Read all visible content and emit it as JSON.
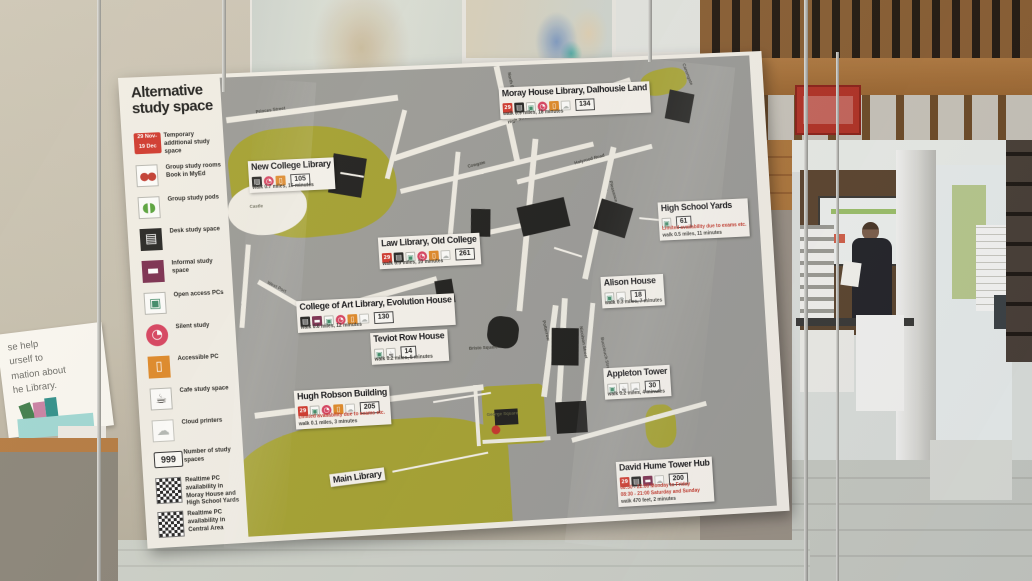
{
  "scene": {
    "left_sign": {
      "lines": [
        "se help",
        "urself to",
        "mation about",
        "he Library."
      ]
    }
  },
  "poster": {
    "title_line1": "Alternative",
    "title_line2": "study space",
    "legend": {
      "date_badge": {
        "line1": "29 Nov-",
        "line2": "19 Dec",
        "description": "Temporary additional study space"
      },
      "items": [
        {
          "icon": "group-study-rooms",
          "label": "Group study rooms Book in MyEd"
        },
        {
          "icon": "group-study-pods",
          "label": "Group study pods"
        },
        {
          "icon": "desk-study",
          "label": "Desk study space"
        },
        {
          "icon": "informal-study",
          "label": "Informal study space"
        },
        {
          "icon": "open-access-pc",
          "label": "Open access PCs"
        },
        {
          "icon": "silent-study",
          "label": "Silent study"
        },
        {
          "icon": "accessible-pc",
          "label": "Accessible PC"
        },
        {
          "icon": "cafe-study",
          "label": "Cafe study space"
        },
        {
          "icon": "cloud-printers",
          "label": "Cloud printers"
        }
      ],
      "number_badge": {
        "value": "999",
        "label": "Number of study spaces"
      },
      "qr_codes": [
        {
          "label": "Realtime PC availability in Moray House and High School Yards"
        },
        {
          "label": "Realtime PC availability in Central Area"
        }
      ]
    },
    "map": {
      "locations": [
        {
          "name": "New College Library",
          "icons": [
            "desk-study",
            "silent-study",
            "accessible-pc"
          ],
          "count": "105",
          "walk": "walk 0.7 miles, 15 minutes"
        },
        {
          "name": "Moray House Library, Dalhousie Land",
          "icons": [
            "date-badge",
            "desk-study",
            "open-access-pc",
            "silent-study",
            "accessible-pc",
            "cloud-printers"
          ],
          "count": "134",
          "walk": "walk 0.9 miles, 18 minutes"
        },
        {
          "name": "Law Library, Old College",
          "icons": [
            "date-badge",
            "desk-study",
            "open-access-pc",
            "silent-study",
            "accessible-pc",
            "cloud-printers"
          ],
          "count": "261",
          "walk": "walk 0.5 miles, 10 minutes"
        },
        {
          "name": "High School Yards",
          "icons": [
            "open-access-pc"
          ],
          "count": "61",
          "note": "Limited availability due to exams etc.",
          "walk": "walk 0.5 miles, 11 minutes"
        },
        {
          "name": "College of Art Library, Evolution House",
          "icons": [
            "desk-study",
            "informal-study",
            "open-access-pc",
            "silent-study",
            "accessible-pc",
            "cloud-printers"
          ],
          "count": "130",
          "walk": "walk 0.6 miles, 12 minutes"
        },
        {
          "name": "Teviot Row House",
          "icons": [
            "open-access-pc",
            "cafe-study"
          ],
          "count": "14",
          "walk": "walk 0.2 miles, 5 minutes"
        },
        {
          "name": "Alison House",
          "icons": [
            "open-access-pc",
            "cloud-printers"
          ],
          "count": "18",
          "walk": "walk 0.3 miles, 7 minutes"
        },
        {
          "name": "Hugh Robson Building",
          "icons": [
            "date-badge",
            "open-access-pc",
            "silent-study",
            "accessible-pc",
            "cloud-printers"
          ],
          "count": "205",
          "note": "Limited availability due to exams etc.",
          "walk": "walk 0.1 miles, 3 minutes"
        },
        {
          "name": "Appleton Tower",
          "icons": [
            "open-access-pc",
            "cafe-study",
            "cloud-printers"
          ],
          "count": "30",
          "walk": "walk 0.2 miles, 4 minutes"
        },
        {
          "name": "David Hume Tower Hub",
          "icons": [
            "date-badge",
            "desk-study",
            "informal-study",
            "cloud-printers"
          ],
          "count": "200",
          "note": "08:30 - 22:00 Monday to Friday",
          "note2": "08:30 - 21:00 Saturday and Sunday",
          "walk": "walk 470 feet, 2 minutes"
        },
        {
          "name": "Main Library"
        }
      ],
      "area_labels": {
        "castle": "Castle",
        "george_square": "George Square",
        "bristo_square": "Bristo Square"
      },
      "streets": [
        "Princes Street",
        "North Bridge",
        "High Street",
        "Canongate",
        "Cowgate",
        "Holyrood Road",
        "Pleasance",
        "Nicolson Street",
        "Potterrow",
        "West Port",
        "Lauriston Place",
        "Buccleuch Street"
      ]
    }
  },
  "icon_glyphs": {
    "date-badge": "29",
    "group-study-rooms": "●●",
    "group-study-pods": "◖◗",
    "desk-study": "▤",
    "informal-study": "▬",
    "open-access-pc": "▣",
    "silent-study": "◔",
    "accessible-pc": "▯",
    "cafe-study": "☕",
    "cloud-printers": "☁"
  },
  "colors": {
    "accent_red": "#d0382c",
    "map_grey": "#9c9c98",
    "park_olive": "#a5a231",
    "poster_white": "#f2eee6"
  }
}
